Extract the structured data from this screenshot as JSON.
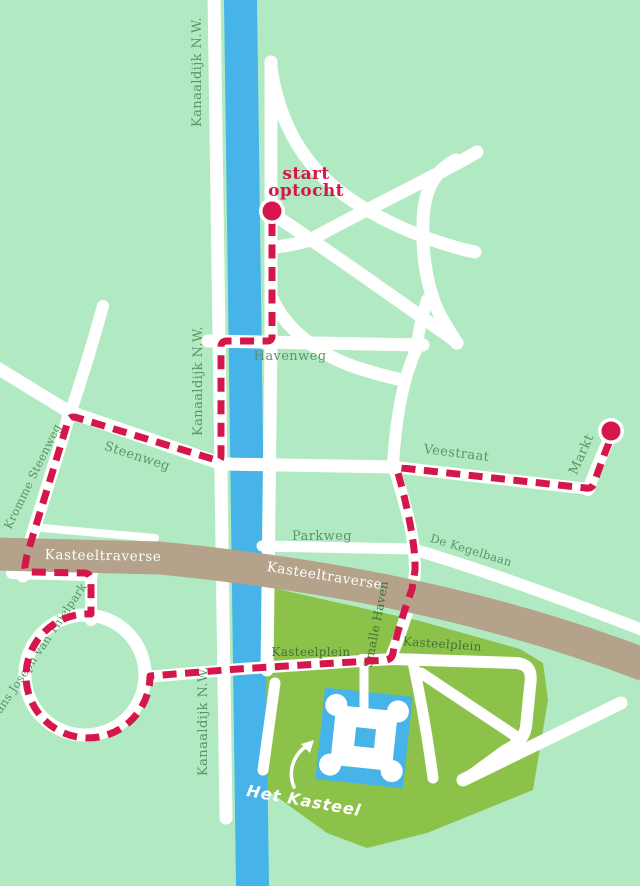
{
  "map": {
    "description": "Parade route map (optocht) around Het Kasteel",
    "colors": {
      "background": "#b1eac2",
      "park": "#8cc24a",
      "water": "#46b4e8",
      "road": "#ffffff",
      "traverse_road": "#b4a28b",
      "route": "#d5164b",
      "label_green": "#5f9168",
      "label_dark_green": "#3f7336"
    },
    "street_labels": {
      "kanaaldijk_top": "Kanaaldijk N.W.",
      "kanaaldijk_mid": "Kanaaldijk N.W.",
      "kanaaldijk_bottom": "Kanaaldijk N.W.",
      "havenweg": "Havenweg",
      "steenweg": "Steenweg",
      "kromme_steenweg": "Kromme Steenweg",
      "veestraat": "Veestraat",
      "markt": "Markt",
      "parkweg": "Parkweg",
      "de_kegelbaan": "De Kegelbaan",
      "kasteeltraverse_west": "Kasteeltraverse",
      "kasteeltraverse_east": "Kasteeltraverse",
      "kasteelplein_west": "Kasteelplein",
      "kasteelplein_east": "Kasteelplein",
      "smalle_haven": "Smalle Haven",
      "frans_joseph_van_thielpark": "Frans Joseph van Thielpark"
    },
    "poi": {
      "het_kasteel": "Het Kasteel"
    },
    "route": {
      "start_label_line1": "start",
      "start_label_line2": "optocht"
    }
  }
}
